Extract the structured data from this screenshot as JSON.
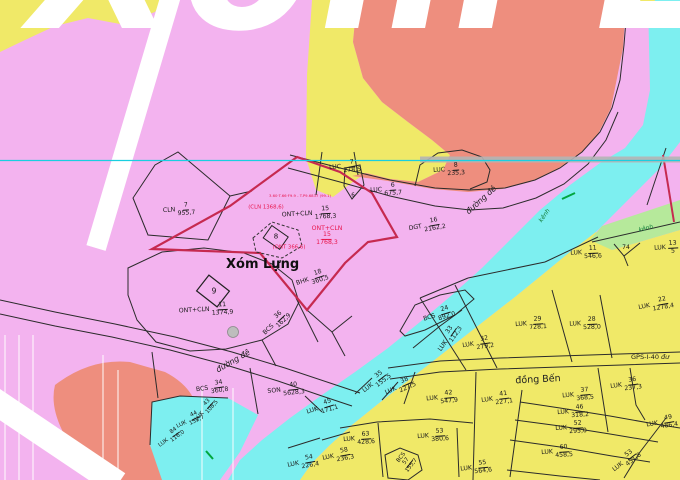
{
  "map": {
    "big_title": "Xóm Lựng",
    "village_label": "Xóm Lựng",
    "place_labels": [
      {
        "text": "đồng Bến",
        "x": 538,
        "y": 380,
        "size": 9.5,
        "rot": -3
      }
    ],
    "road_labels": [
      {
        "text": "đường đê",
        "x": 481,
        "y": 200,
        "rot": -42,
        "size": 8
      },
      {
        "text": "đường đê",
        "x": 233,
        "y": 361,
        "rot": -30,
        "size": 8
      }
    ],
    "gps_marker": "GPS-I-40",
    "gps_road_stub": "đư",
    "canal_labels": [
      {
        "text": "kênh",
        "x": 545,
        "y": 216,
        "rot": -55
      },
      {
        "text": "kênh",
        "x": 646,
        "y": 229,
        "rot": -14
      }
    ],
    "river_parcel": {
      "code": "SON",
      "num": "40",
      "den": "5628,3"
    },
    "parcels": [
      {
        "c": "CLN",
        "n": "7",
        "d": "955,7",
        "x": 179,
        "y": 210,
        "r": -4
      },
      {
        "c": "ONT+CLN",
        "n": "11",
        "d": "1374,9",
        "x": 206,
        "y": 310,
        "r": -3
      },
      {
        "c": "BHK",
        "n": "18",
        "d": "360,5",
        "x": 312,
        "y": 279,
        "r": -18
      },
      {
        "c": "BCS",
        "n": "36",
        "d": "162,9",
        "x": 276,
        "y": 323,
        "r": -44
      },
      {
        "c": "BCS",
        "n": "34",
        "d": "360,8",
        "x": 212,
        "y": 388,
        "r": -8
      },
      {
        "c": "DGT",
        "n": "16",
        "d": "2162,2",
        "x": 427,
        "y": 226,
        "r": -10
      },
      {
        "c": "LUC",
        "n": "7",
        "d": "278,5",
        "x": 345,
        "y": 167,
        "r": -4
      },
      {
        "c": "LUC",
        "n": "6",
        "d": "675,7",
        "x": 386,
        "y": 190,
        "r": -3
      },
      {
        "c": "LUC",
        "n": "8",
        "d": "235,3",
        "x": 449,
        "y": 170,
        "r": -3
      },
      {
        "c": "SON",
        "n": "40",
        "d": "5628,3",
        "x": 286,
        "y": 390,
        "r": -6
      },
      {
        "c": "ONT+CLN",
        "n": "15",
        "d": "1768,3",
        "x": 309,
        "y": 214,
        "r": -3
      },
      {
        "c": "ONT+CLN",
        "n": "15",
        "d": "1768,3",
        "x": 327,
        "y": 236,
        "r": 0,
        "col": "red",
        "st": true
      },
      {
        "c": "LUK",
        "n": "11",
        "d": "546,6",
        "x": 586,
        "y": 253,
        "r": -2
      },
      {
        "c": "LUK",
        "n": "13",
        "d": "5",
        "x": 666,
        "y": 248,
        "r": -3
      },
      {
        "c": "LUK",
        "n": "22",
        "d": "1278,4",
        "x": 656,
        "y": 305,
        "r": -10
      },
      {
        "c": "BCS",
        "n": "24",
        "d": "892,0",
        "x": 439,
        "y": 315,
        "r": -17
      },
      {
        "c": "LUK",
        "n": "33",
        "d": "112,3",
        "x": 449,
        "y": 338,
        "r": -55
      },
      {
        "c": "LUK",
        "n": "32",
        "d": "279,2",
        "x": 478,
        "y": 344,
        "r": -8
      },
      {
        "c": "LUK",
        "n": "29",
        "d": "728,1",
        "x": 531,
        "y": 324,
        "r": -4
      },
      {
        "c": "LUK",
        "n": "28",
        "d": "528,0",
        "x": 585,
        "y": 324,
        "r": -2
      },
      {
        "c": "LUK",
        "n": "35",
        "d": "155,5",
        "x": 376,
        "y": 382,
        "r": -38
      },
      {
        "c": "LUK",
        "n": "38",
        "d": "227,5",
        "x": 400,
        "y": 387,
        "r": -24
      },
      {
        "c": "LUK",
        "n": "42",
        "d": "547,9",
        "x": 442,
        "y": 398,
        "r": -5
      },
      {
        "c": "LUK",
        "n": "41",
        "d": "227,1",
        "x": 497,
        "y": 399,
        "r": -7
      },
      {
        "c": "LUK",
        "n": "37",
        "d": "368,5",
        "x": 578,
        "y": 395,
        "r": -5
      },
      {
        "c": "LUK",
        "n": "36",
        "d": "237,3",
        "x": 626,
        "y": 385,
        "r": -7
      },
      {
        "c": "LUK",
        "n": "46",
        "d": "318,2",
        "x": 573,
        "y": 412,
        "r": -4
      },
      {
        "c": "LUK",
        "n": "52",
        "d": "295,0",
        "x": 571,
        "y": 428,
        "r": -3
      },
      {
        "c": "LUK",
        "n": "49",
        "d": "486,4",
        "x": 662,
        "y": 423,
        "r": -9
      },
      {
        "c": "LUK",
        "n": "63",
        "d": "428,6",
        "x": 359,
        "y": 439,
        "r": -4
      },
      {
        "c": "LUK",
        "n": "53",
        "d": "380,6",
        "x": 433,
        "y": 436,
        "r": -4
      },
      {
        "c": "BCS",
        "n": "57",
        "d": "155,7",
        "x": 407,
        "y": 462,
        "r": -52,
        "st": true,
        "s": 5.6
      },
      {
        "c": "LUK",
        "n": "55",
        "d": "564,6",
        "x": 476,
        "y": 468,
        "r": -6
      },
      {
        "c": "LUK",
        "n": "60",
        "d": "458,5",
        "x": 557,
        "y": 452,
        "r": -4
      },
      {
        "c": "LUK",
        "n": "53",
        "d": "451,8",
        "x": 626,
        "y": 461,
        "r": -38
      },
      {
        "c": "LUK",
        "n": "45",
        "d": "171,1",
        "x": 322,
        "y": 408,
        "r": -17
      },
      {
        "c": "LUK",
        "n": "54",
        "d": "226,4",
        "x": 303,
        "y": 463,
        "r": -10
      },
      {
        "c": "LUK",
        "n": "58",
        "d": "236,3",
        "x": 338,
        "y": 456,
        "r": -10
      },
      {
        "c": "LUK",
        "n": "43",
        "d": "108,5",
        "x": 206,
        "y": 410,
        "r": -48,
        "s": 5.6
      },
      {
        "c": "LUK",
        "n": "44",
        "d": "152,7",
        "x": 190,
        "y": 421,
        "r": -26,
        "s": 5.6
      },
      {
        "c": "LUK",
        "n": "84",
        "d": "116,0",
        "x": 171,
        "y": 438,
        "r": -36,
        "s": 5.6
      }
    ],
    "red_annotations": [
      {
        "text": "3.60·T.66·F9.9 - T.P9.6837 (99.1)",
        "x": 300,
        "y": 196,
        "s": 3.8
      },
      {
        "text": "(CLN 1368,6)",
        "x": 266,
        "y": 208,
        "s": 5.4
      },
      {
        "text": "(ONT 366,6)",
        "x": 289,
        "y": 248,
        "s": 5.4
      }
    ],
    "plot_numbers": [
      {
        "text": "6",
        "x": 353,
        "y": 196,
        "s": 5.5
      },
      {
        "text": "8",
        "x": 276,
        "y": 237,
        "s": 7
      },
      {
        "text": "9",
        "x": 214,
        "y": 291,
        "s": 7.5
      },
      {
        "text": "74",
        "x": 626,
        "y": 248,
        "s": 6
      }
    ],
    "colors": {
      "pink_residential": "#f3b3ef",
      "yellow_paddy": "#f0e968",
      "salmon_zone": "#ee8e7e",
      "cyan_river": "#7deff0",
      "green_canal": "#b6e99b",
      "red_boundary": "#c62a50",
      "red_text": "#e8174d",
      "black_boundary": "#2b2b2b",
      "grid_cyan_line": "#19cfe0",
      "gray_line": "#b4b4b4"
    }
  }
}
